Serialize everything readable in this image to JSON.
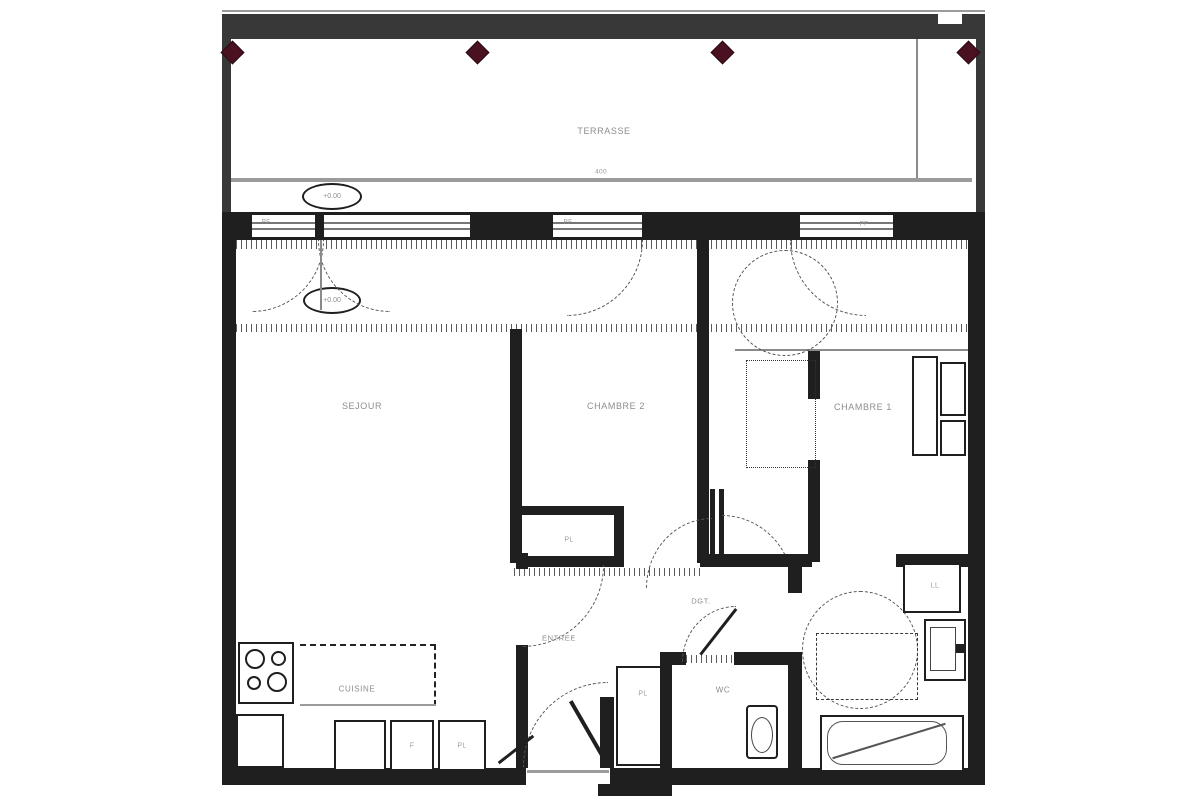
{
  "plan": {
    "rooms": {
      "terrasse": "TERRASSE",
      "sejour": "SEJOUR",
      "chambre2": "CHAMBRE 2",
      "chambre1": "CHAMBRE 1",
      "cuisine": "CUISINE",
      "entree": "ENTREE",
      "dgt": "DGT.",
      "wc": "WC"
    },
    "closets": {
      "pl_chambre2": "PL",
      "pl_hall": "PL",
      "pl_kitchen": "PL"
    },
    "appliances": {
      "fridge": "F",
      "washer": "LL"
    },
    "windows": {
      "pf1": "PF",
      "pf2": "PF",
      "pf3": "PF"
    },
    "levels": {
      "terrace": "+0.00",
      "interior": "+0.00"
    },
    "dimensions": {
      "terrace_width": "400"
    },
    "colors": {
      "wall": "#1f1f1f",
      "beam": "#383838",
      "gray_line": "#9b9b9b",
      "marker": "#4a1120",
      "label": "#8d8d8d"
    }
  }
}
